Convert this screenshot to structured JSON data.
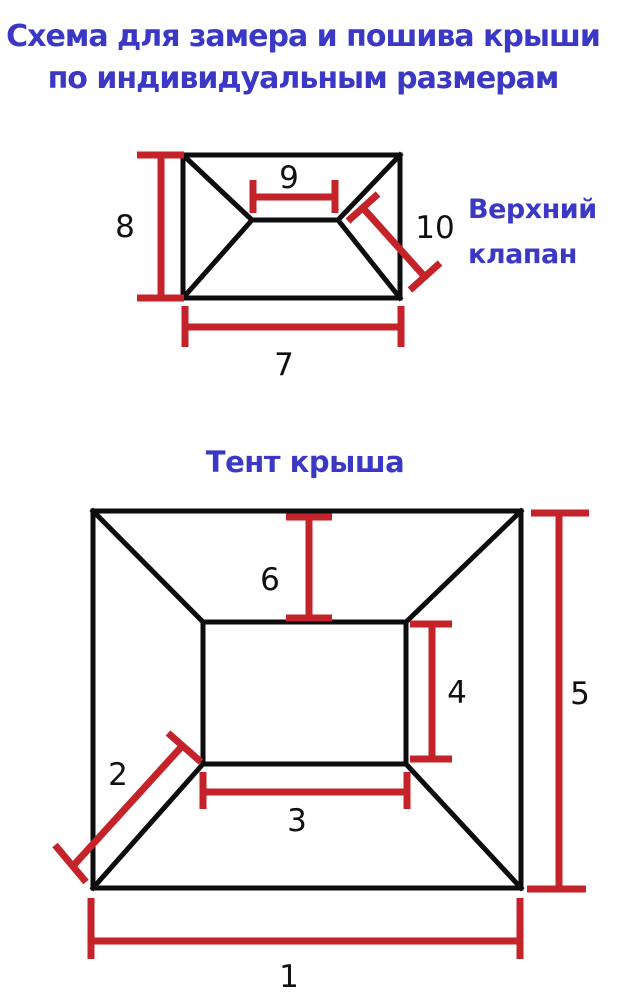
{
  "page": {
    "title_line1": "Схема для замера и пошива крыши",
    "title_line2": "по индивидуальным размерам"
  },
  "colors": {
    "accent_blue": "#3a38c4",
    "measure_red": "#c42329",
    "line_black": "#0d0d0d",
    "digit_black": "#111111"
  },
  "top_diagram": {
    "side_label_line1": "Верхний",
    "side_label_line2": "клапан",
    "measurements": {
      "left_height": "8",
      "ridge_width": "9",
      "flap_length": "10",
      "bottom_width": "7"
    }
  },
  "bottom_diagram": {
    "title": "Тент крыша",
    "measurements": {
      "outer_width": "1",
      "corner_slope": "2",
      "inner_width": "3",
      "inner_height": "4",
      "outer_height": "5",
      "top_slope": "6"
    }
  }
}
